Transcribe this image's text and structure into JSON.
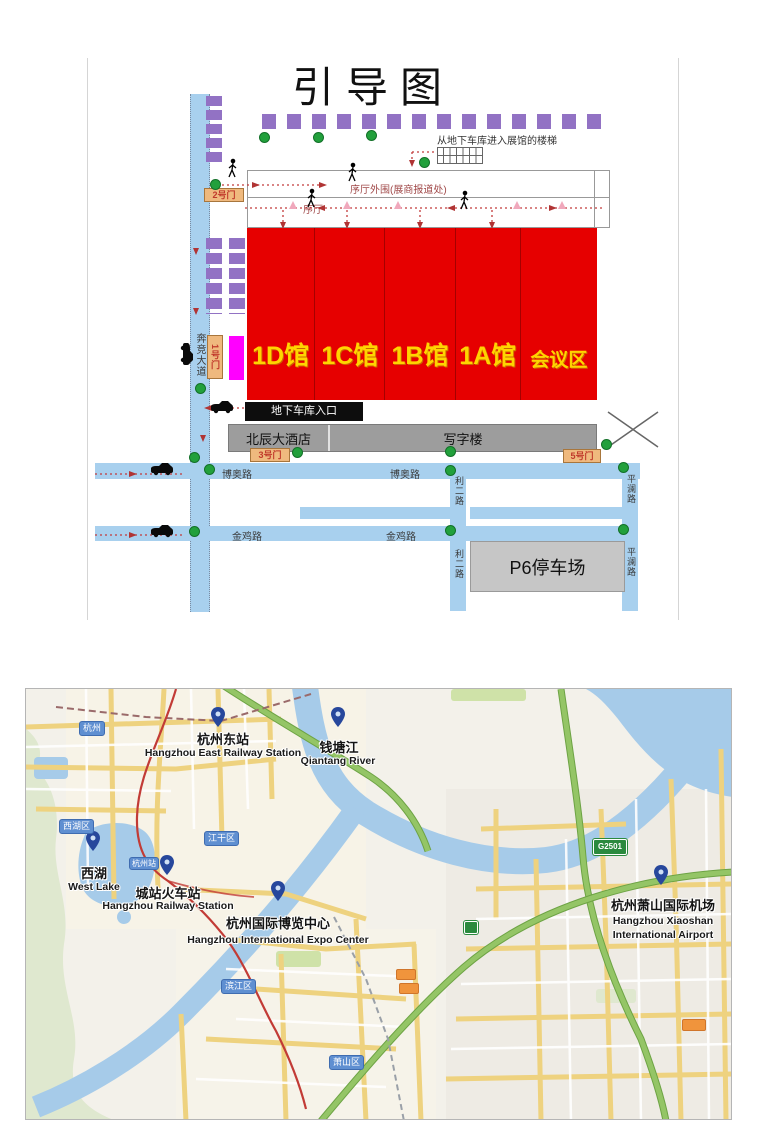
{
  "diagram": {
    "title": "引导图",
    "stairs_note": "从地下车库进入展馆的楼梯",
    "lobby_outer": "序厅外围(展商报道处)",
    "lobby": "序厅",
    "halls": [
      "1D馆",
      "1C馆",
      "1B馆",
      "1A馆",
      "会议区"
    ],
    "gates": {
      "g1": "1号门",
      "g2": "2号门",
      "g3": "3号门",
      "g5": "5号门"
    },
    "garage_entrance": "地下车库入口",
    "hotel": "北辰大酒店",
    "office": "写字楼",
    "parking": "P6停车场",
    "roads": {
      "benjing": "奔竞大道",
      "boao": "博奥路",
      "jinji": "金鸡路",
      "lier": "利二路",
      "pinglan": "平澜路"
    }
  },
  "map": {
    "city_badge": "杭州",
    "station_badge": "杭州站",
    "districts": {
      "xihu": "西湖区",
      "jianggan": "江干区",
      "binjiang": "滨江区",
      "xiaoshan": "萧山区"
    },
    "shield": "G2501",
    "pois": {
      "east_station": {
        "zh": "杭州东站",
        "en": "Hangzhou East Railway Station"
      },
      "qiantang": {
        "zh": "钱塘江",
        "en": "Qiantang River"
      },
      "west_lake": {
        "zh": "西湖",
        "en": "West Lake"
      },
      "city_station": {
        "zh": "城站火车站",
        "en": "Hangzhou Railway Station"
      },
      "expo": {
        "zh": "杭州国际博览中心",
        "en": "Hangzhou International Expo Center"
      },
      "airport": {
        "zh": "杭州萧山国际机场",
        "en": "Hangzhou Xiaoshan",
        "en2": "International Airport"
      }
    }
  },
  "colors": {
    "hall_red": "#e60000",
    "hall_label_yellow": "#ffd400",
    "road_blue": "#a8d0ee",
    "block_purple": "#9272c4",
    "gate_orange": "#efb97e",
    "gate_text_red": "#c0392b",
    "dot_green": "#22a03c",
    "vip_magenta": "#ff00ff",
    "water_blue": "#a6cbe9",
    "highway_green": "#94c566",
    "road_yellow": "#eed27f"
  }
}
